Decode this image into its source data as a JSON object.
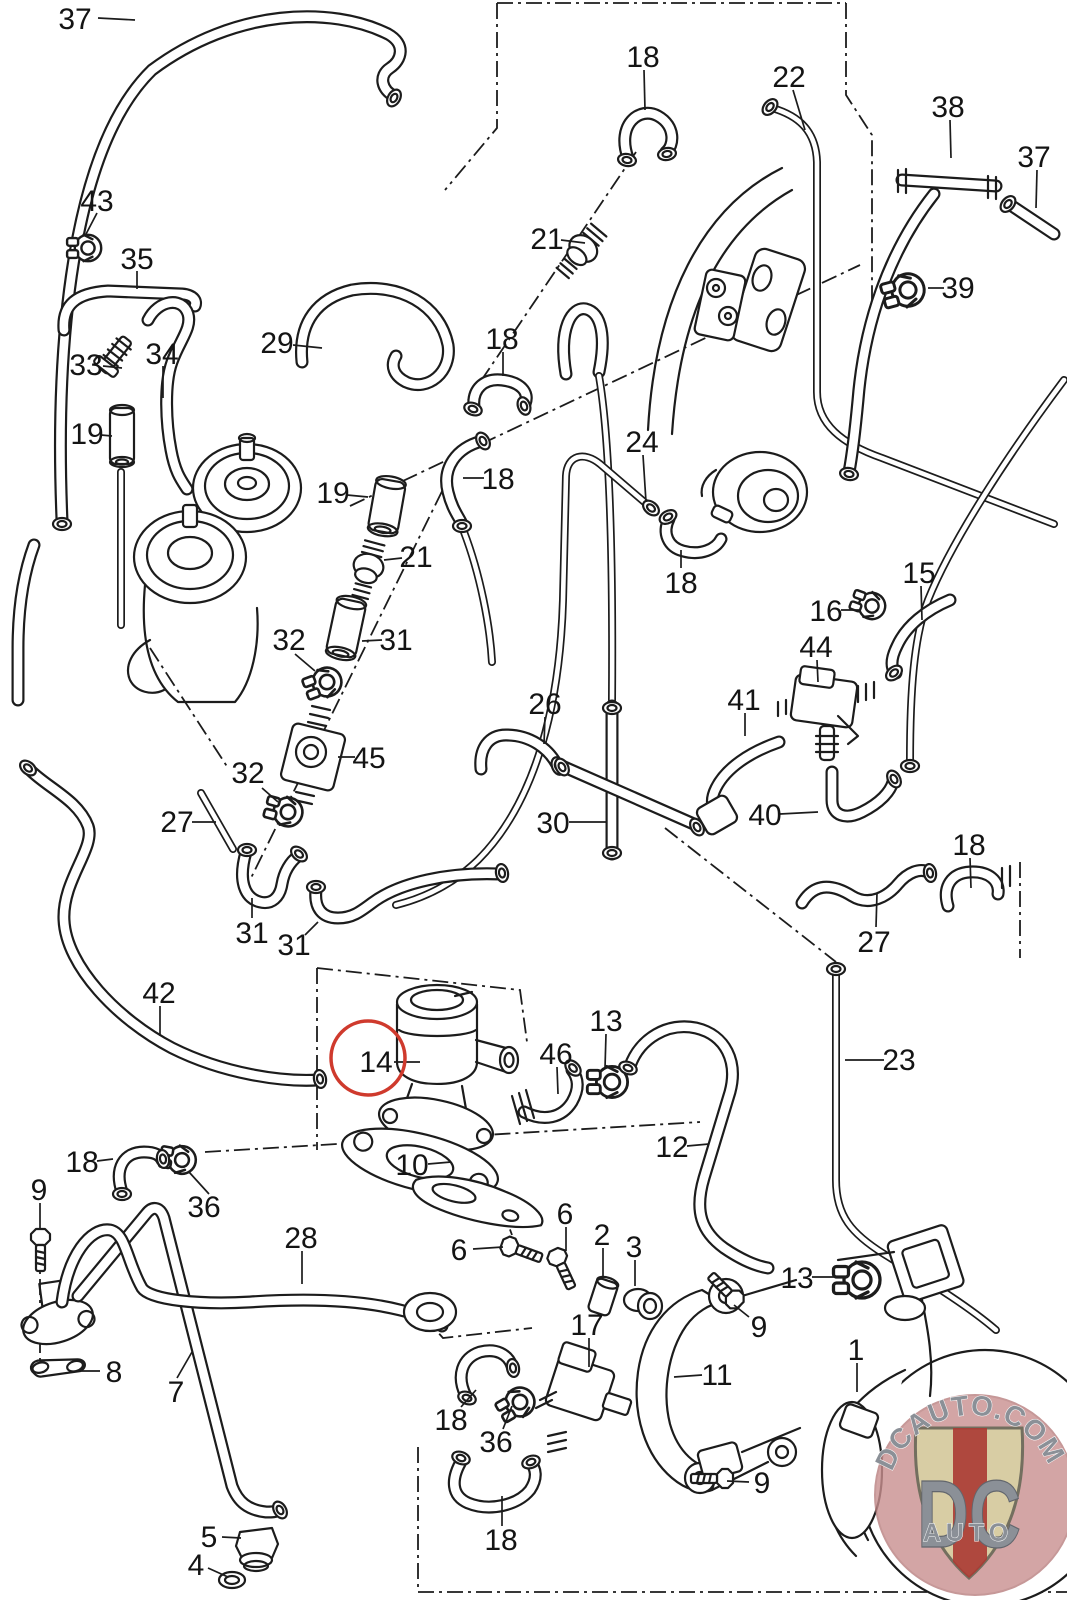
{
  "diagram": {
    "type": "exploded-parts-diagram",
    "line_color": "#1c1c1c",
    "background": "#ffffff",
    "highlight": {
      "part": "14",
      "shape": "circle",
      "x": 368,
      "y": 1058,
      "r": 37,
      "color": "#cf3a2d"
    },
    "part_numbers_visible": [
      "1",
      "2",
      "3",
      "4",
      "5",
      "6",
      "7",
      "8",
      "9",
      "10",
      "11",
      "12",
      "13",
      "14",
      "15",
      "16",
      "17",
      "18",
      "19",
      "21",
      "22",
      "23",
      "24",
      "26",
      "27",
      "28",
      "29",
      "30",
      "31",
      "32",
      "33",
      "34",
      "35",
      "36",
      "37",
      "38",
      "39",
      "40",
      "41",
      "42",
      "43",
      "44",
      "45",
      "46"
    ],
    "labels": [
      {
        "t": "37",
        "x": 75,
        "y": 18,
        "l": [
          98,
          18,
          135,
          20
        ]
      },
      {
        "t": "43",
        "x": 97,
        "y": 200,
        "l": [
          97,
          213,
          85,
          236
        ]
      },
      {
        "t": "35",
        "x": 137,
        "y": 258,
        "l": [
          137,
          271,
          137,
          289
        ]
      },
      {
        "t": "33",
        "x": 86,
        "y": 364,
        "l": [
          103,
          366,
          122,
          368
        ]
      },
      {
        "t": "34",
        "x": 162,
        "y": 353,
        "l": [
          163,
          366,
          163,
          398
        ]
      },
      {
        "t": "19",
        "x": 87,
        "y": 433,
        "l": [
          101,
          435,
          112,
          436
        ]
      },
      {
        "t": "29",
        "x": 277,
        "y": 342,
        "l": [
          293,
          345,
          322,
          348
        ]
      },
      {
        "t": "19",
        "x": 333,
        "y": 492,
        "l": [
          347,
          495,
          368,
          497
        ]
      },
      {
        "t": "18",
        "x": 643,
        "y": 56,
        "l": [
          644,
          70,
          645,
          110
        ]
      },
      {
        "t": "22",
        "x": 789,
        "y": 76,
        "l": [
          793,
          90,
          805,
          130
        ]
      },
      {
        "t": "21",
        "x": 547,
        "y": 238,
        "l": [
          561,
          240,
          585,
          243
        ]
      },
      {
        "t": "38",
        "x": 948,
        "y": 106,
        "l": [
          950,
          120,
          951,
          158
        ]
      },
      {
        "t": "37",
        "x": 1034,
        "y": 156,
        "l": [
          1037,
          170,
          1036,
          208
        ]
      },
      {
        "t": "39",
        "x": 958,
        "y": 287,
        "l": [
          944,
          288,
          928,
          288
        ]
      },
      {
        "t": "18",
        "x": 502,
        "y": 338,
        "l": [
          503,
          352,
          503,
          376
        ]
      },
      {
        "t": "18",
        "x": 498,
        "y": 478,
        "l": [
          484,
          478,
          463,
          478
        ]
      },
      {
        "t": "24",
        "x": 642,
        "y": 441,
        "l": [
          643,
          455,
          646,
          502
        ]
      },
      {
        "t": "18",
        "x": 681,
        "y": 582,
        "l": [
          681,
          568,
          681,
          550
        ]
      },
      {
        "t": "15",
        "x": 919,
        "y": 572,
        "l": [
          921,
          586,
          922,
          620
        ]
      },
      {
        "t": "16",
        "x": 826,
        "y": 610,
        "l": [
          841,
          610,
          859,
          610
        ]
      },
      {
        "t": "44",
        "x": 816,
        "y": 646,
        "l": [
          817,
          660,
          818,
          682
        ]
      },
      {
        "t": "41",
        "x": 744,
        "y": 699,
        "l": [
          745,
          713,
          745,
          736
        ]
      },
      {
        "t": "40",
        "x": 765,
        "y": 814,
        "l": [
          780,
          814,
          818,
          812
        ]
      },
      {
        "t": "21",
        "x": 416,
        "y": 556,
        "l": [
          402,
          558,
          384,
          560
        ]
      },
      {
        "t": "31",
        "x": 396,
        "y": 639,
        "l": [
          382,
          640,
          362,
          641
        ]
      },
      {
        "t": "32",
        "x": 289,
        "y": 639,
        "l": [
          295,
          654,
          315,
          671
        ]
      },
      {
        "t": "45",
        "x": 369,
        "y": 757,
        "l": [
          355,
          757,
          338,
          757
        ]
      },
      {
        "t": "32",
        "x": 248,
        "y": 772,
        "l": [
          262,
          788,
          278,
          802
        ]
      },
      {
        "t": "26",
        "x": 545,
        "y": 703,
        "l": [
          545,
          717,
          544,
          744
        ]
      },
      {
        "t": "30",
        "x": 553,
        "y": 822,
        "l": [
          569,
          822,
          606,
          822
        ]
      },
      {
        "t": "27",
        "x": 177,
        "y": 821,
        "l": [
          192,
          822,
          216,
          822
        ]
      },
      {
        "t": "31",
        "x": 252,
        "y": 932,
        "l": [
          252,
          918,
          252,
          898
        ]
      },
      {
        "t": "31",
        "x": 294,
        "y": 944,
        "l": [
          305,
          935,
          318,
          922
        ]
      },
      {
        "t": "42",
        "x": 159,
        "y": 992,
        "l": [
          160,
          1006,
          160,
          1036
        ]
      },
      {
        "t": "18",
        "x": 969,
        "y": 844,
        "l": [
          970,
          858,
          971,
          888
        ]
      },
      {
        "t": "27",
        "x": 874,
        "y": 941,
        "l": [
          876,
          927,
          877,
          893
        ]
      },
      {
        "t": "23",
        "x": 899,
        "y": 1059,
        "l": [
          884,
          1060,
          845,
          1060
        ]
      },
      {
        "t": "14",
        "x": 376,
        "y": 1061,
        "l": [
          394,
          1062,
          420,
          1062
        ]
      },
      {
        "t": "46",
        "x": 556,
        "y": 1053,
        "l": [
          557,
          1067,
          558,
          1094
        ]
      },
      {
        "t": "13",
        "x": 606,
        "y": 1020,
        "l": [
          606,
          1034,
          605,
          1068
        ]
      },
      {
        "t": "12",
        "x": 672,
        "y": 1146,
        "l": [
          687,
          1146,
          709,
          1144
        ]
      },
      {
        "t": "10",
        "x": 412,
        "y": 1164,
        "l": [
          428,
          1164,
          451,
          1162
        ]
      },
      {
        "t": "6",
        "x": 565,
        "y": 1213,
        "l": [
          566,
          1227,
          566,
          1251
        ]
      },
      {
        "t": "6",
        "x": 459,
        "y": 1249,
        "l": [
          473,
          1249,
          503,
          1247
        ]
      },
      {
        "t": "2",
        "x": 602,
        "y": 1234,
        "l": [
          603,
          1248,
          603,
          1276
        ]
      },
      {
        "t": "3",
        "x": 634,
        "y": 1246,
        "l": [
          635,
          1260,
          635,
          1286
        ]
      },
      {
        "t": "17",
        "x": 587,
        "y": 1324,
        "l": [
          589,
          1338,
          589,
          1367
        ]
      },
      {
        "t": "18",
        "x": 451,
        "y": 1419,
        "l": [
          461,
          1407,
          476,
          1390
        ]
      },
      {
        "t": "36",
        "x": 496,
        "y": 1441,
        "l": [
          503,
          1429,
          512,
          1406
        ]
      },
      {
        "t": "18",
        "x": 501,
        "y": 1539,
        "l": [
          502,
          1526,
          502,
          1496
        ]
      },
      {
        "t": "13",
        "x": 797,
        "y": 1277,
        "l": [
          812,
          1277,
          841,
          1277
        ]
      },
      {
        "t": "9",
        "x": 759,
        "y": 1326,
        "l": [
          749,
          1317,
          734,
          1305
        ]
      },
      {
        "t": "11",
        "x": 717,
        "y": 1374,
        "l": [
          702,
          1375,
          674,
          1377
        ]
      },
      {
        "t": "1",
        "x": 856,
        "y": 1349,
        "l": [
          857,
          1363,
          857,
          1392
        ]
      },
      {
        "t": "9",
        "x": 762,
        "y": 1482,
        "l": [
          749,
          1482,
          727,
          1481
        ]
      },
      {
        "t": "5",
        "x": 209,
        "y": 1536,
        "l": [
          222,
          1537,
          241,
          1538
        ]
      },
      {
        "t": "4",
        "x": 196,
        "y": 1564,
        "l": [
          208,
          1568,
          228,
          1577
        ]
      },
      {
        "t": "9",
        "x": 39,
        "y": 1189,
        "l": [
          40,
          1203,
          40,
          1230
        ]
      },
      {
        "t": "18",
        "x": 82,
        "y": 1161,
        "l": [
          97,
          1161,
          113,
          1159
        ]
      },
      {
        "t": "36",
        "x": 204,
        "y": 1206,
        "l": [
          209,
          1194,
          189,
          1172
        ]
      },
      {
        "t": "28",
        "x": 301,
        "y": 1237,
        "l": [
          302,
          1251,
          302,
          1284
        ]
      },
      {
        "t": "8",
        "x": 114,
        "y": 1371,
        "l": [
          100,
          1371,
          81,
          1371
        ]
      },
      {
        "t": "7",
        "x": 176,
        "y": 1391,
        "l": [
          177,
          1378,
          192,
          1352
        ]
      }
    ]
  },
  "watermark": {
    "site_text": "DCAUTO.COM",
    "shield_top": "DC",
    "shield_bottom": "AUTO",
    "x": 975,
    "y": 1495,
    "r": 100,
    "circle_color": "#c98f8f",
    "shield_color": "#d9d1a4",
    "stripe_color": "#ab3a33",
    "letter_color": "#8b9097"
  }
}
